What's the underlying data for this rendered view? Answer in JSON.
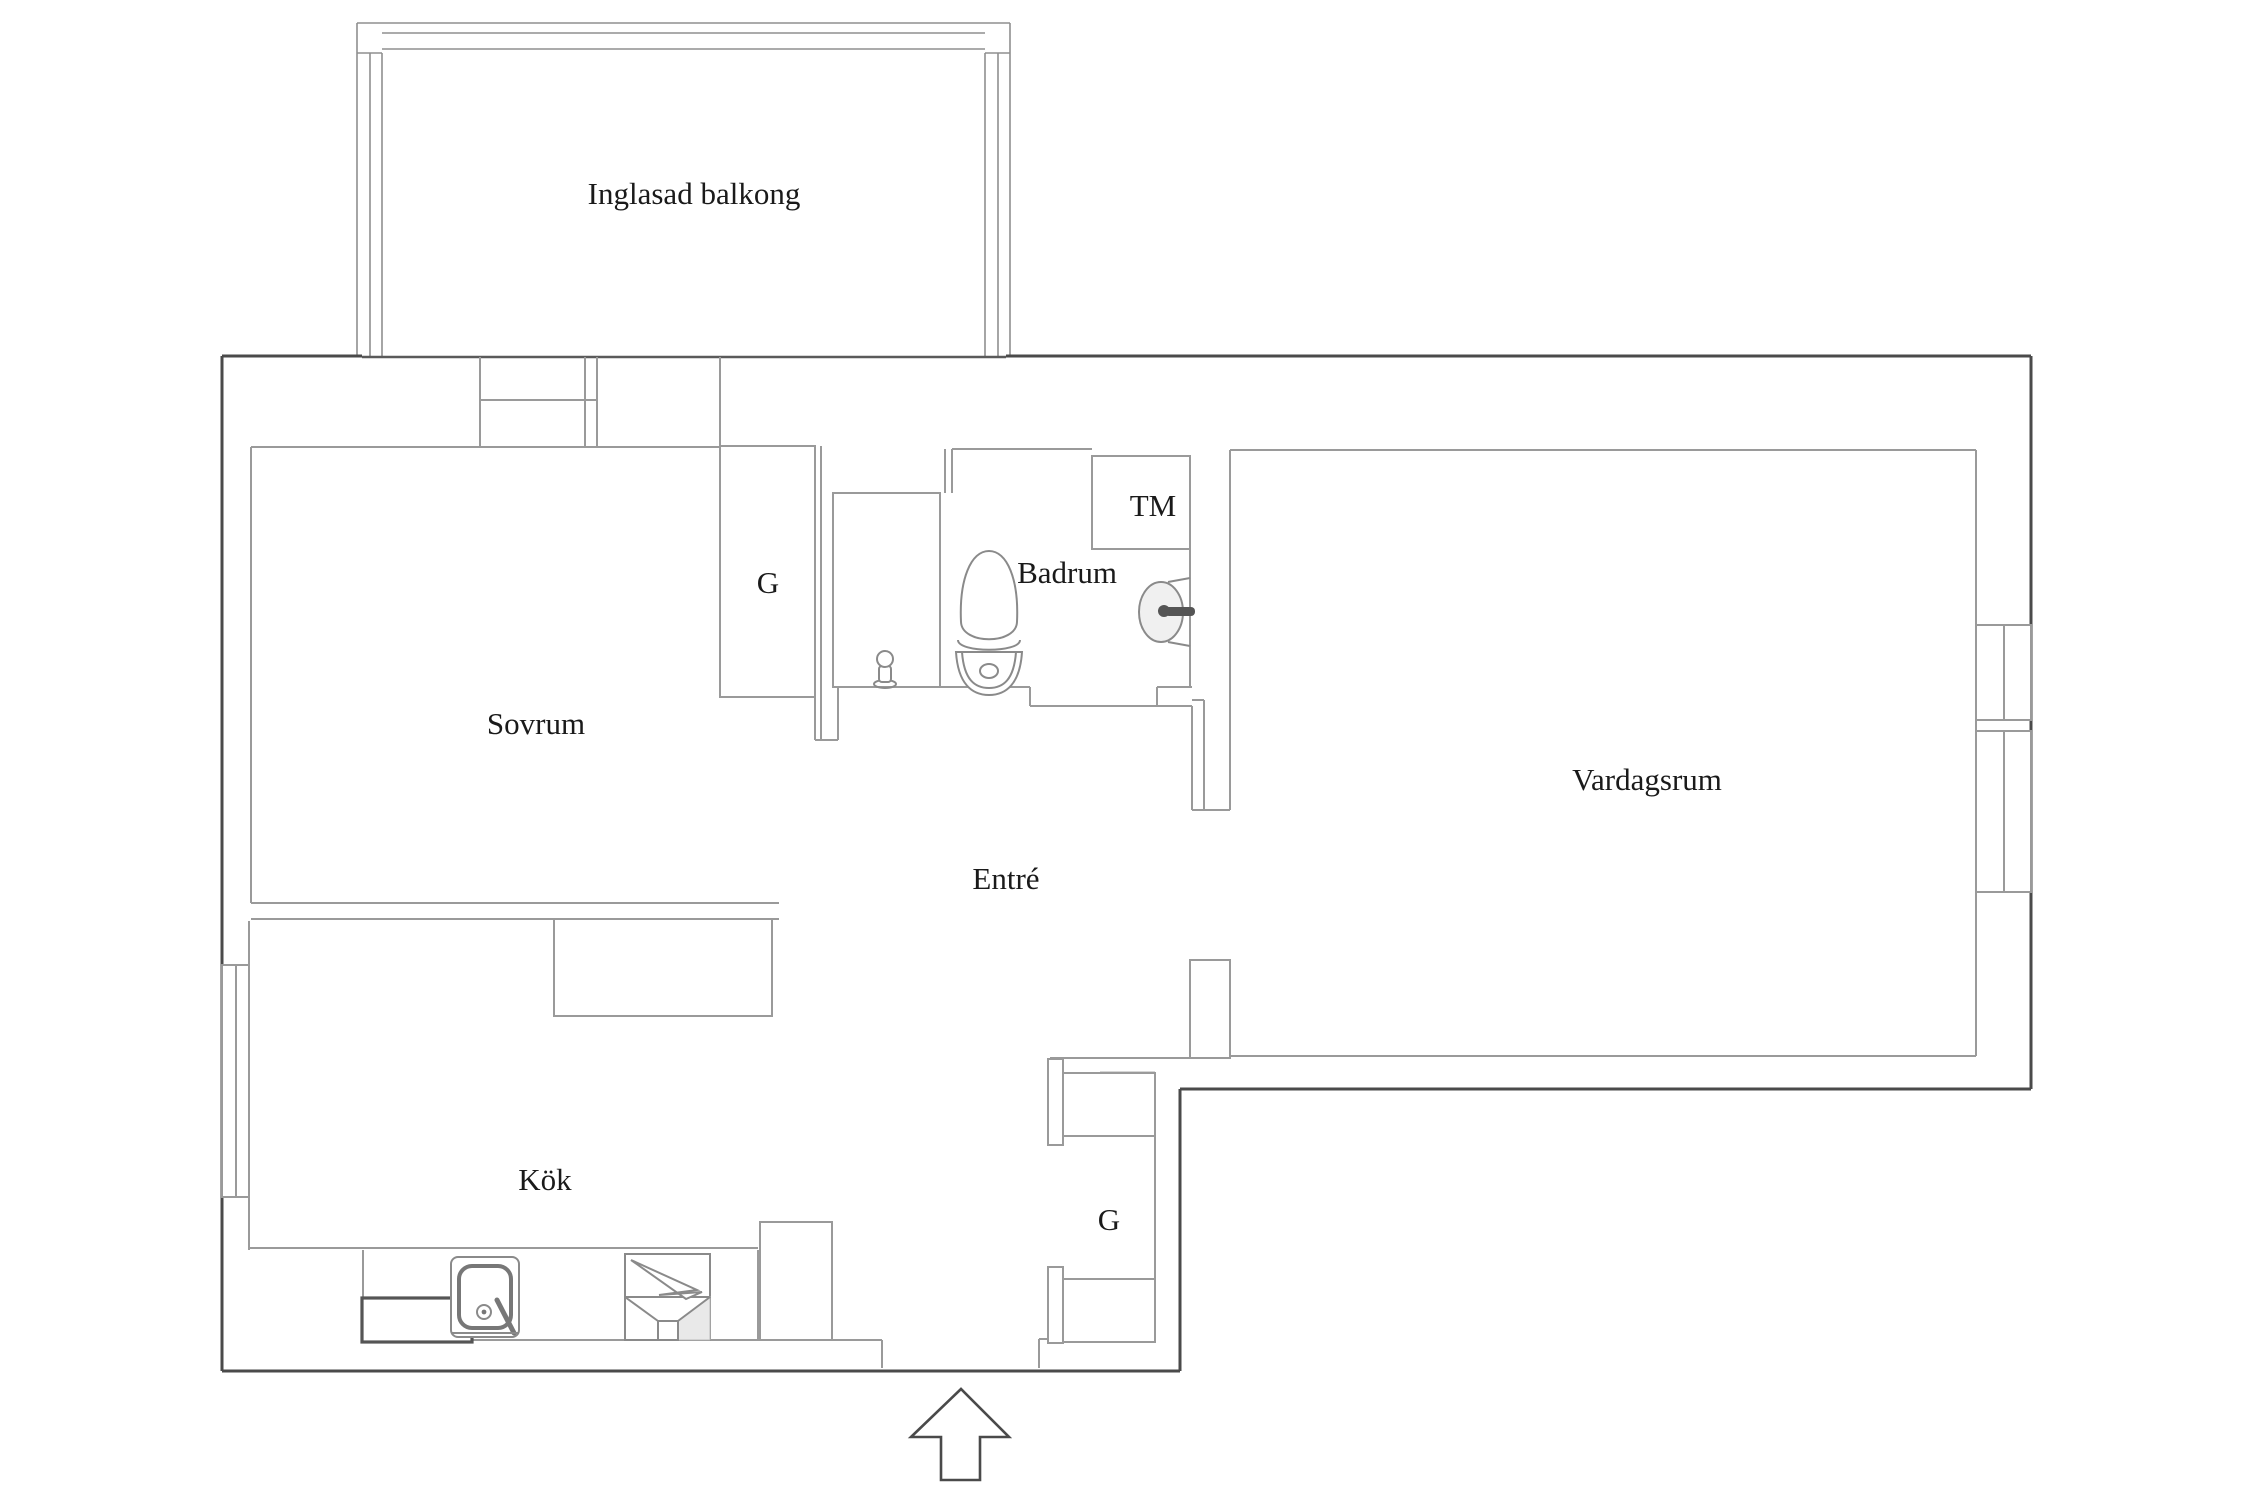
{
  "document": {
    "type": "apartment-floor-plan",
    "background_color": "#ffffff",
    "style": "Swedish broker floor plan, serif labels, thin gray interior walls, darker outer boundary"
  },
  "colors": {
    "outer_wall": "#4a4a4a",
    "interior_wall": "#9a9a9a",
    "fixture_outline": "#8a8a8a",
    "dark_fixture": "#555555",
    "label_text": "#1a1a1a",
    "shading": "#ededed"
  },
  "labels": {
    "balcony": "Inglasad balkong",
    "bedroom": "Sovrum",
    "bedroom_closet": "G",
    "bathroom": "Badrum",
    "washing_machine": "TM",
    "living_room": "Vardagsrum",
    "hallway": "Entré",
    "kitchen": "Kök",
    "hallway_closet": "G"
  },
  "icons": {
    "entrance_arrow": "up-arrow at bottom marking the apartment entrance",
    "toilet": "toilet symbol in bathroom",
    "washbasin": "wall-mounted washbasin with tap in bathroom",
    "shower_mixer": "shower mixer symbol in shower cabin",
    "kitchen_sink": "kitchen sink with faucet and drain",
    "stove": "stove/oven symbol with funnel marking",
    "windows": "double-pane window symbols on left and right exterior walls"
  }
}
